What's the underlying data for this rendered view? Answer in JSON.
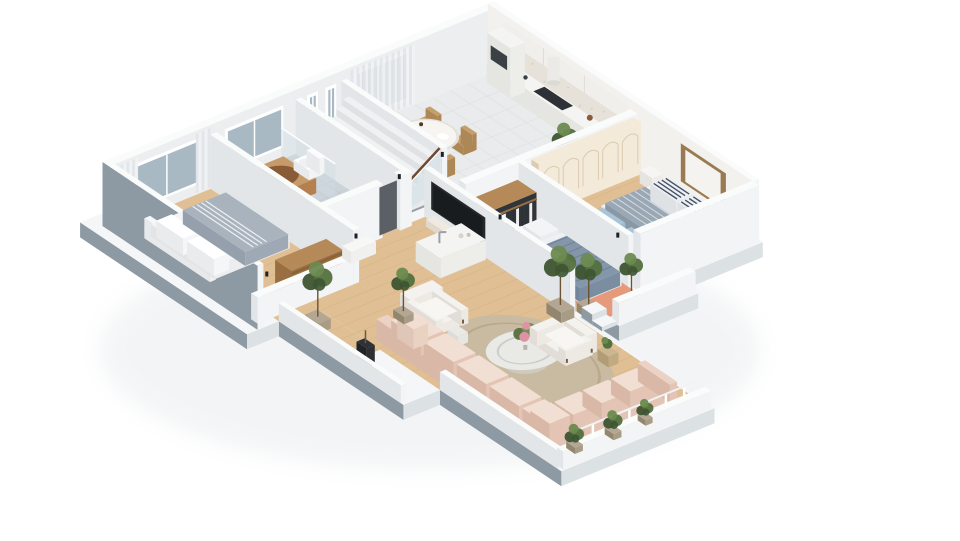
{
  "scene": {
    "type": "3d-isometric-floor-plan-render",
    "background": "#ffffff",
    "description": "Photoreal cutaway dollhouse view of a furnished apartment seen from above at an angle, on a plain white background. No text labels are rendered."
  },
  "colors": {
    "bg": "#ffffff",
    "shadow": "#93a0aa",
    "plate_top": "#f5f6f7",
    "plate_side_sw": "#8d99a3",
    "plate_side_se": "#dce1e4",
    "plate_side_faint": "#e9edef",
    "wall_top": "#fafbfb",
    "wall_shade": "#e3e6e8",
    "wall_lit": "#f3f4f5",
    "wall_in_nw": "#eceef0",
    "wall_in_ne": "#f2f1ee",
    "window_frame": "#ffffff",
    "glass": "#a9b9c3",
    "curtain_a": "#f0f2f4",
    "curtain_b": "#e1e5e9",
    "wood": "#e0bf94",
    "wood_line": "#c9a97c",
    "tile_kitchen": "#e9ebec",
    "tile_kitchen_line": "#d9dcde",
    "tile_bath": "#ccd4d9",
    "tile_bath_line": "#bcc5cb",
    "stair_void": "#97a0a7",
    "stair_step": "#f0f1f2",
    "stair_glass": "#cfdfe8",
    "handrail": "#6e4a33",
    "door_dark": "#5a6065",
    "splash": "#e6e2da",
    "cabinet": "#f1efec",
    "cabinet_line": "#dfdcd6",
    "counter": "#f4f4f2",
    "counter_side": "#e5e5e2",
    "counter_front": "#ededea",
    "cooktop": "#2e3236",
    "oven": "#3b4045",
    "chair_wood": "#c59e6b",
    "chair_wood_d": "#ad8756",
    "bottle": "#38271e",
    "bottle2": "#50392a",
    "sofa": "#ecd2c4",
    "sofa_dark": "#d9b8a7",
    "sofa_mid": "#e4c5b5",
    "sofa_light": "#f2dfd3",
    "chair_white": "#f4f2ee",
    "chair_shadow": "#e2ded7",
    "chair_front": "#edeae4",
    "leg_wood": "#7d5b3e",
    "rug_round": "#c9bba2",
    "rug_inner": "#baa98c",
    "rug_coral": "#e49a7b",
    "marble": "#e9e9e6",
    "marble_shadow": "#d4d4d0",
    "flower_green": "#5d7544",
    "flower_green2": "#74905a",
    "flower_pink": "#de93a4",
    "flower_pink2": "#eaacb8",
    "plant_dark": "#3e5432",
    "plant_mid": "#53703e",
    "plant_light": "#6c8a4f",
    "pot": "#b3a793",
    "pot_dark": "#92866f",
    "pot_mid": "#a89c86",
    "bed_white": "#f3f4f5",
    "bed_base_shade": "#e2e4e6",
    "bed_base_front": "#ecedee",
    "bed_gray": "#a9b3be",
    "bed_gray_d": "#95a0ac",
    "bed_gray_f": "#9fa9b5",
    "kid_duvet": "#9aa7b5",
    "kid_duvet_d": "#8a97a5",
    "kid_duvet_f": "#92a0ae",
    "pillow_navy": "#32405a",
    "kid_blue": "#a9c3d8",
    "kid_blue_d": "#92b0c8",
    "kid_blue_f": "#9dbad0",
    "duvet_blue": "#8496a9",
    "duvet_dark": "#72859a",
    "duvet_mid": "#7b8da1",
    "duvet_stripe": "#66798e",
    "wardrobe_cream": "#f3ead9",
    "wardrobe_line": "#dbcbb2",
    "closet_wood": "#b68a58",
    "closet_wood_dark": "#996f42",
    "closet_dark_in": "#30353a",
    "cloth_dark": "#2d3237",
    "cloth_light": "#eff0ee",
    "tub_rim": "#c79a6a",
    "tub": "#b5804f",
    "tub_dark": "#9a6a3e",
    "tub_inner": "#8a5c36",
    "basket": "#c9b08c",
    "washer": "#f1f2f2",
    "washer_door": "#2b2f33",
    "console": "#efe9e1",
    "console_d": "#e0d8cc",
    "console_f": "#e8e1d7",
    "tv": "#25282b",
    "tv_dark": "#191c1e",
    "chrome": "#9aa0a5",
    "frame_wood": "#9a7a50",
    "frame_canvas": "#f4f3ef",
    "vase_black": "#2d3033",
    "gold": "#cbb691",
    "gold_d": "#b29c75",
    "gold_f": "#c0aa83"
  },
  "rooms": [
    {
      "id": "bedroom-left",
      "floor": "wood",
      "furniture": [
        "double-bed-white-bedding",
        "gray-blanket",
        "striped-throw",
        "open-clothes-rack-with-dark-clothes",
        "sheer-curtains",
        "window"
      ]
    },
    {
      "id": "bathroom",
      "floor": "gray-tile",
      "furniture": [
        "copper-bathtub",
        "toilet",
        "washing-machine",
        "glass-shower-panel",
        "basket",
        "window"
      ]
    },
    {
      "id": "staircase",
      "floor": "void",
      "furniture": [
        "descending-steps",
        "glass-balustrade",
        "dark-wood-handrail",
        "two-narrow-windows"
      ]
    },
    {
      "id": "kitchen-dining",
      "floor": "light-tile",
      "furniture": [
        "wall-counter",
        "black-cooktop",
        "oven-tower",
        "cylindrical-range-hood",
        "mosaic-backsplash",
        "upper-cabinets",
        "dining-table",
        "wood-dining-chairs",
        "wine-bottles",
        "plates",
        "sheer-curtains",
        "tall-plant"
      ]
    },
    {
      "id": "bedroom-right",
      "floor": "wood",
      "furniture": [
        "cream-arched-wardrobe",
        "single-bed-gray-duvet",
        "navy-striped-pillows",
        "leaning-picture-frame",
        "two-light-blue-chairs",
        "nightstand",
        "corner-plant"
      ]
    },
    {
      "id": "master-bedroom",
      "floor": "wood",
      "furniture": [
        "double-bed-blue-striped-duvet",
        "open-wood-closet-with-clothes",
        "coral-rug",
        "tv-on-low-console",
        "potted-plants"
      ]
    },
    {
      "id": "living-room",
      "floor": "wood",
      "furniture": [
        "pink-modular-corner-sofa",
        "two-white-boucle-armchairs",
        "oval-marble-coffee-table",
        "flower-arrangement",
        "round-jute-rug",
        "white-island-with-faucet",
        "wall-mounted-tv",
        "marble-drum-side-table",
        "gold-side-table",
        "tall-potted-plants",
        "black-floor-vase",
        "terrace-railing-posts",
        "terrace-planters"
      ]
    }
  ],
  "hallway": {
    "furniture": [
      "white-console-table",
      "dark-interior-door",
      "black-wall-spotlights"
    ]
  }
}
